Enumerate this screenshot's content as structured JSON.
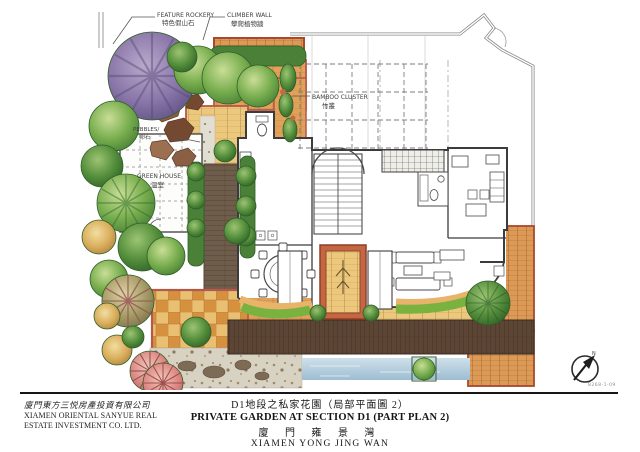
{
  "plan": {
    "drawing_no": "8268-1-09",
    "labels": {
      "feature_rockery_en": "FEATURE ROCKERY",
      "feature_rockery_cn": "特色假山石",
      "climber_wall_en": "CLIMBER WALL",
      "climber_wall_cn": "攀爬植物牆",
      "bamboo_cluster_en": "BAMBOO CLUSTER",
      "bamboo_cluster_cn": "竹叢",
      "pebbles_en": "PEBBLES/",
      "pebbles_cn": "卵石",
      "green_house_en": "GREEN HOUSE",
      "green_house_cn": "溫室",
      "north": "N"
    },
    "colors": {
      "tree_green": "#79ae4f",
      "tree_purple": "#8a76a8",
      "palm_pink": "#dd8a84",
      "hedge_green": "#4a8038",
      "tile_orange": "#e2a159",
      "tile_yellow": "#ecc87d",
      "brick_red": "#b3584a",
      "deck_brown": "#5c4534",
      "gravel": "#d8d2c2",
      "water_blue": "#9dbdd2"
    }
  },
  "footer": {
    "company_cn": "廈門東方三悦房產投資有限公司",
    "company_en_line1": "XIAMEN ORIENTAL SANYUE REAL",
    "company_en_line2": "ESTATE INVESTMENT CO. LTD.",
    "title_cn": "D1地段之私家花園（局部平面圖 2）",
    "title_en": "PRIVATE GARDEN AT SECTION D1 (PART PLAN 2)",
    "project_cn": "廈 門 雍 景 灣",
    "project_en": "XIAMEN YONG JING WAN"
  }
}
